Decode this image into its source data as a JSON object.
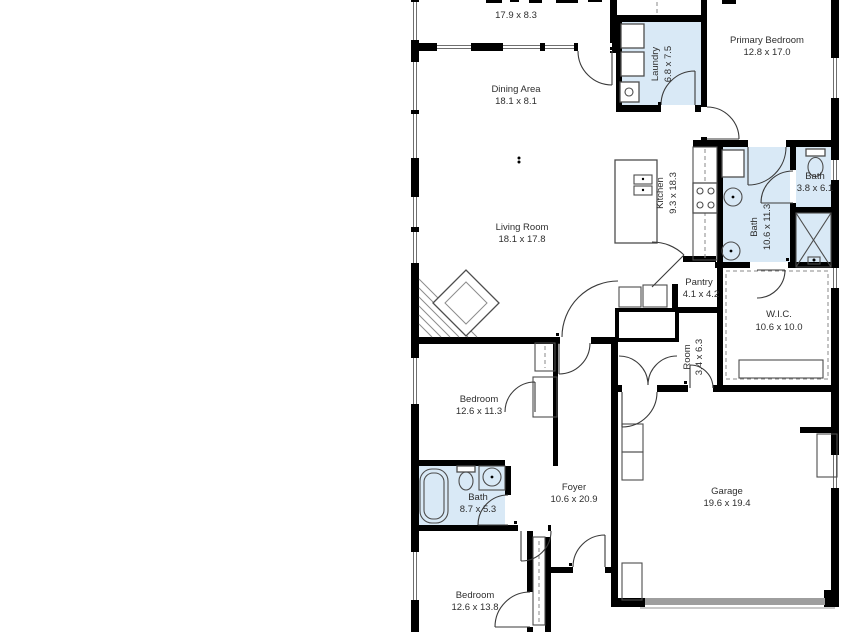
{
  "floorplan": {
    "background": "#ffffff",
    "wall_color": "#000000",
    "wet_area_color": "#d9e9f6",
    "garage_door_color": "#9e9e9e",
    "label_color": "#2e2e2e",
    "rooms": [
      {
        "name": "",
        "dims": "17.9 x 8.3"
      },
      {
        "name": "Dining Area",
        "dims": "18.1 x 8.1"
      },
      {
        "name": "Laundry",
        "dims": "6.8 x 7.5"
      },
      {
        "name": "Primary Bedroom",
        "dims": "12.8 x 17.0"
      },
      {
        "name": "Living Room",
        "dims": "18.1 x 17.8"
      },
      {
        "name": "Kitchen",
        "dims": "9.3 x 18.3"
      },
      {
        "name": "Bath",
        "dims": "10.6 x 11.3"
      },
      {
        "name": "Bath",
        "dims": "3.8 x 6.1"
      },
      {
        "name": "Pantry",
        "dims": "4.1 x 4.2"
      },
      {
        "name": "W.I.C.",
        "dims": "10.6 x 10.0"
      },
      {
        "name": "Room",
        "dims": "3.4 x 6.3"
      },
      {
        "name": "Bedroom",
        "dims": "12.6 x 11.3"
      },
      {
        "name": "Bath",
        "dims": "8.7 x 5.3"
      },
      {
        "name": "Foyer",
        "dims": "10.6 x 20.9"
      },
      {
        "name": "Garage",
        "dims": "19.6 x 19.4"
      },
      {
        "name": "Bedroom",
        "dims": "12.6 x 13.8"
      }
    ]
  }
}
